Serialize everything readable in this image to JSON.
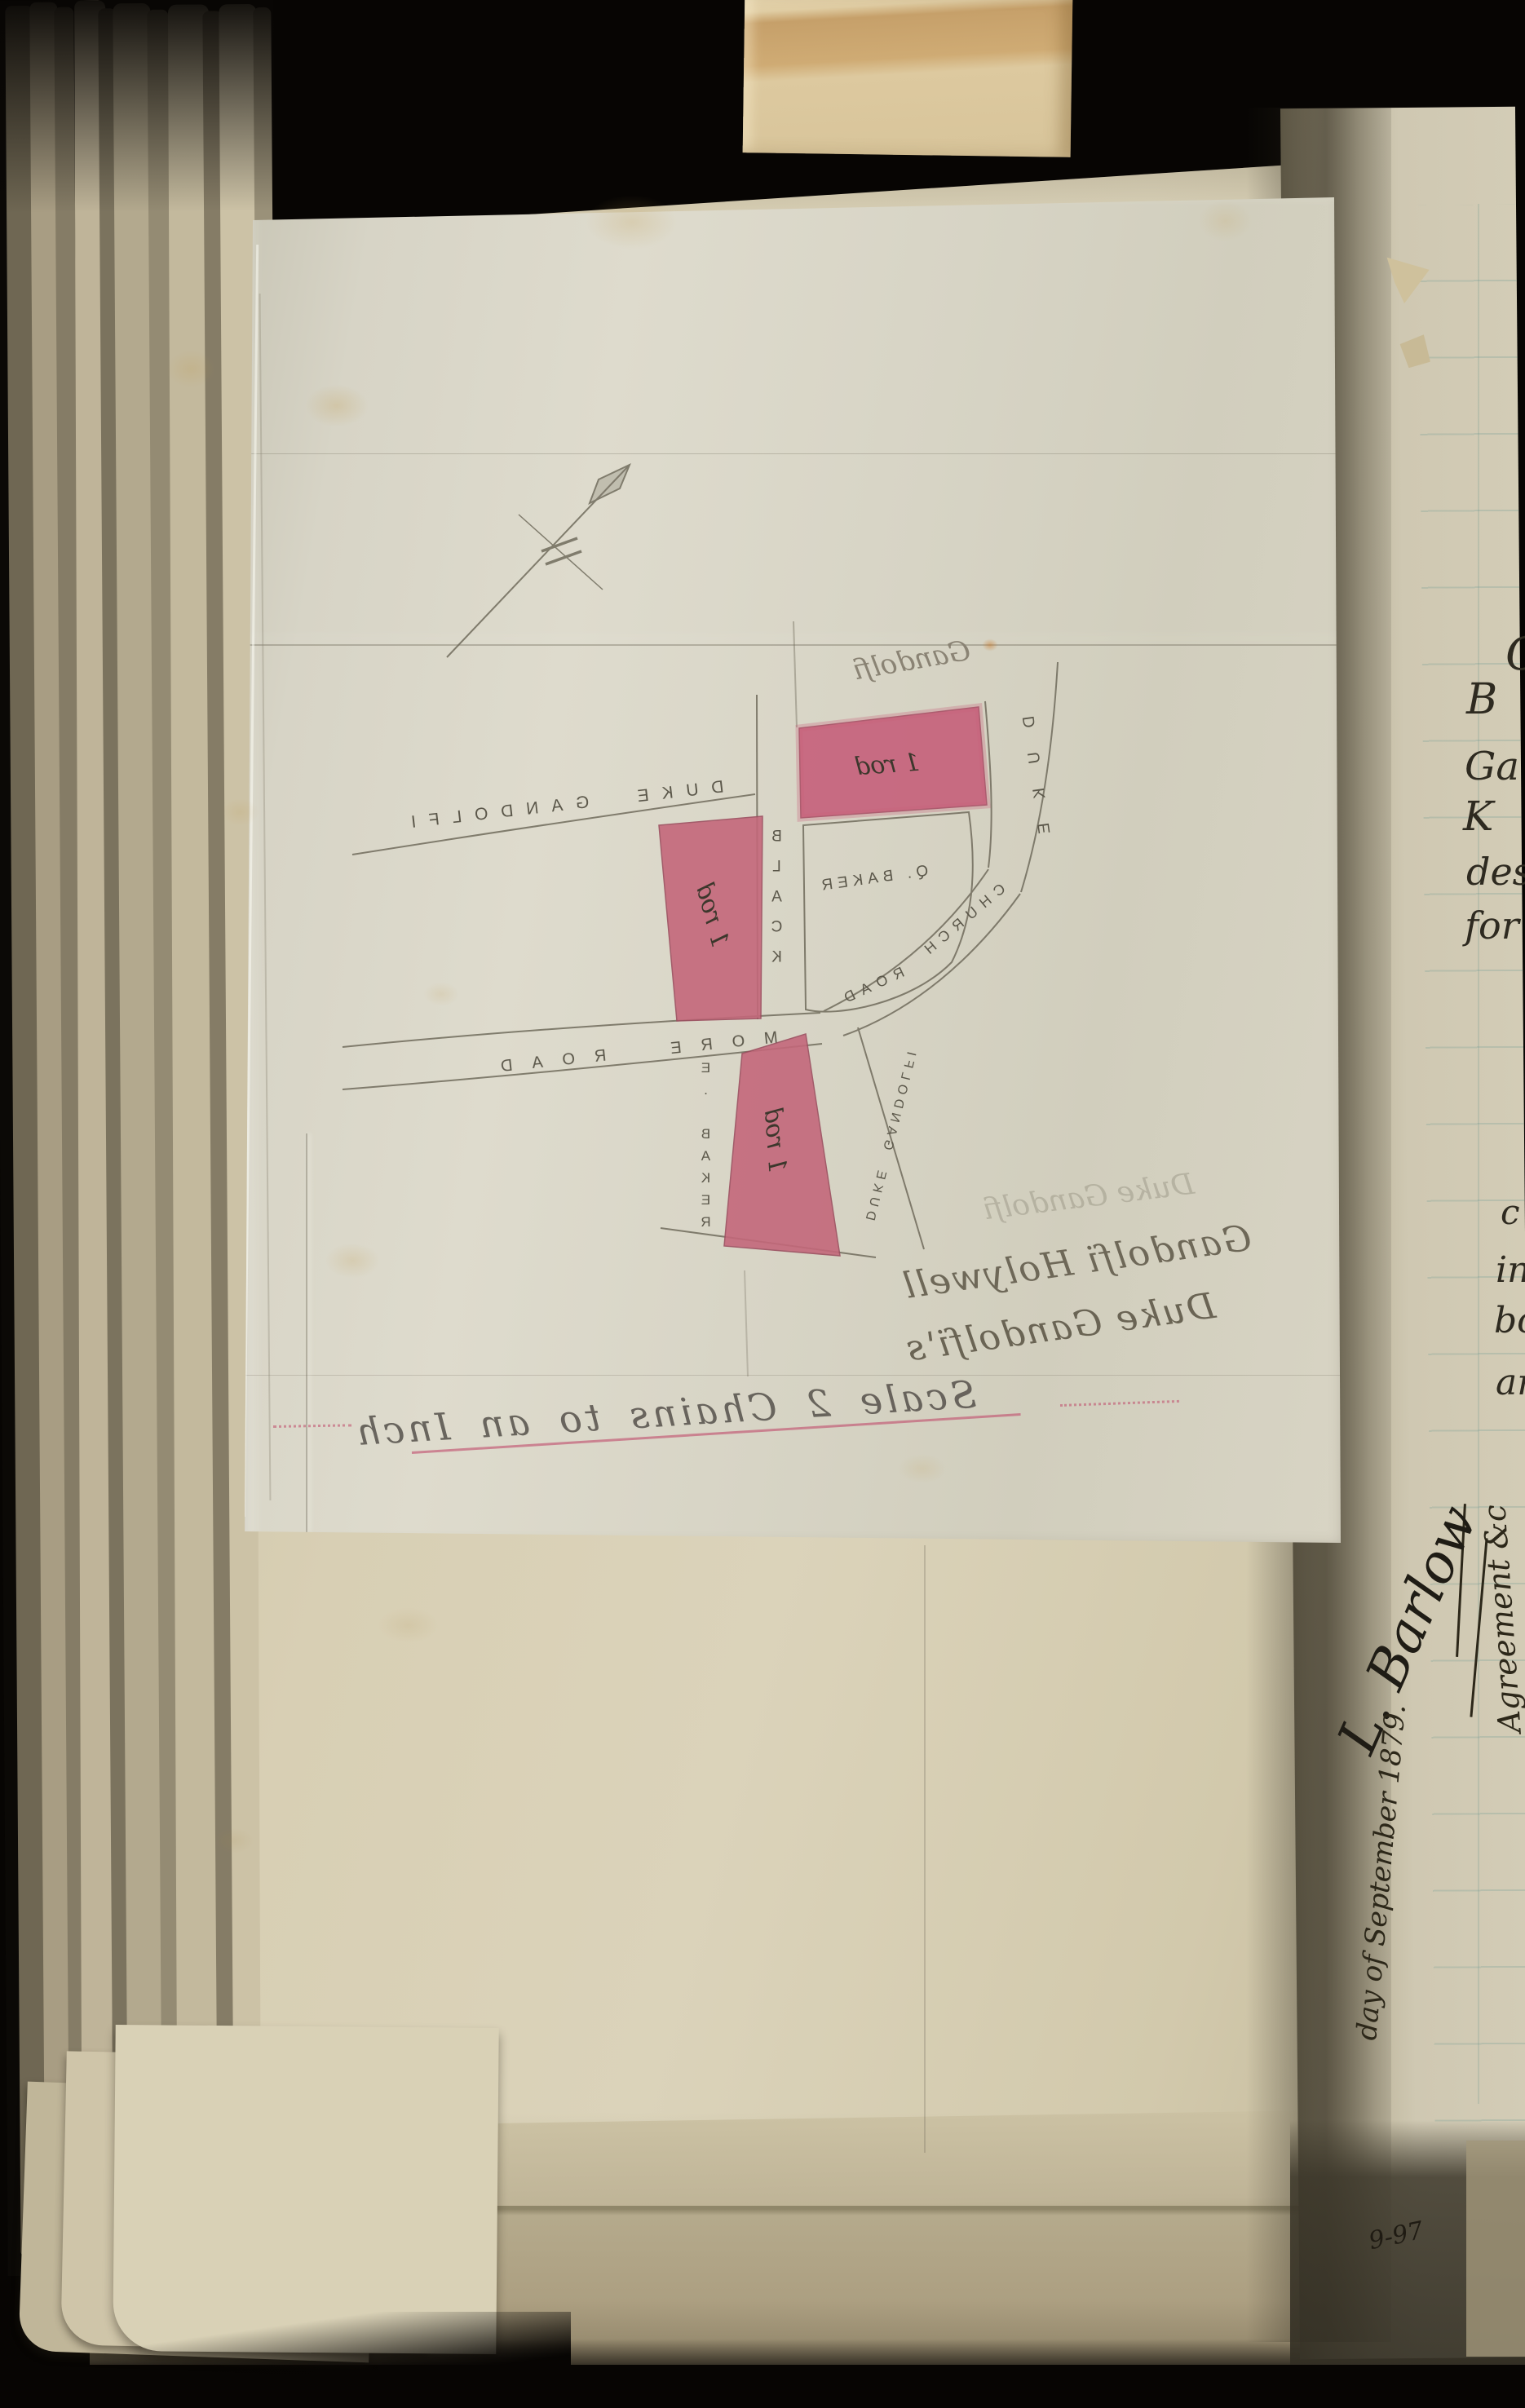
{
  "map": {
    "streets": {
      "duke_gandolfi_top": "DUKE GANDOLFI",
      "duke_vertical": "DUKE",
      "gandolfi_script": "Gandolfi",
      "black": "BLACK",
      "more_road": "MORE ROAD",
      "church": "CHURCH",
      "road": "ROAD",
      "duke_gandolfi_small": "DUKE GANDOLFI"
    },
    "owners": {
      "q_baker": "Q. BAKER",
      "e_baker": "E. BAKER"
    },
    "parcels": {
      "top": "1 rod",
      "middle": "1 rod",
      "bottom": "1 rod"
    },
    "notes": {
      "ghost": "Duke Gandolfi",
      "line1": "Gandolfi Holywell",
      "line2": "Duke Gandolfi's"
    },
    "scale": "Scale 2 Chains to an Inch"
  },
  "right_page": {
    "fragments": [
      "C",
      "B",
      "Ga",
      "K",
      "des",
      "for",
      "c",
      "in",
      "bo",
      "an"
    ],
    "memo": "Agreement &c",
    "signature": "L. Barlow",
    "date_line": "day of September 1879.",
    "corner_number": "9-97"
  },
  "colors": {
    "parcel_pink": "#c4687a",
    "pink_ink": "#c25571",
    "pencil": "#6f6b5c",
    "ink": "#2e2a20"
  }
}
